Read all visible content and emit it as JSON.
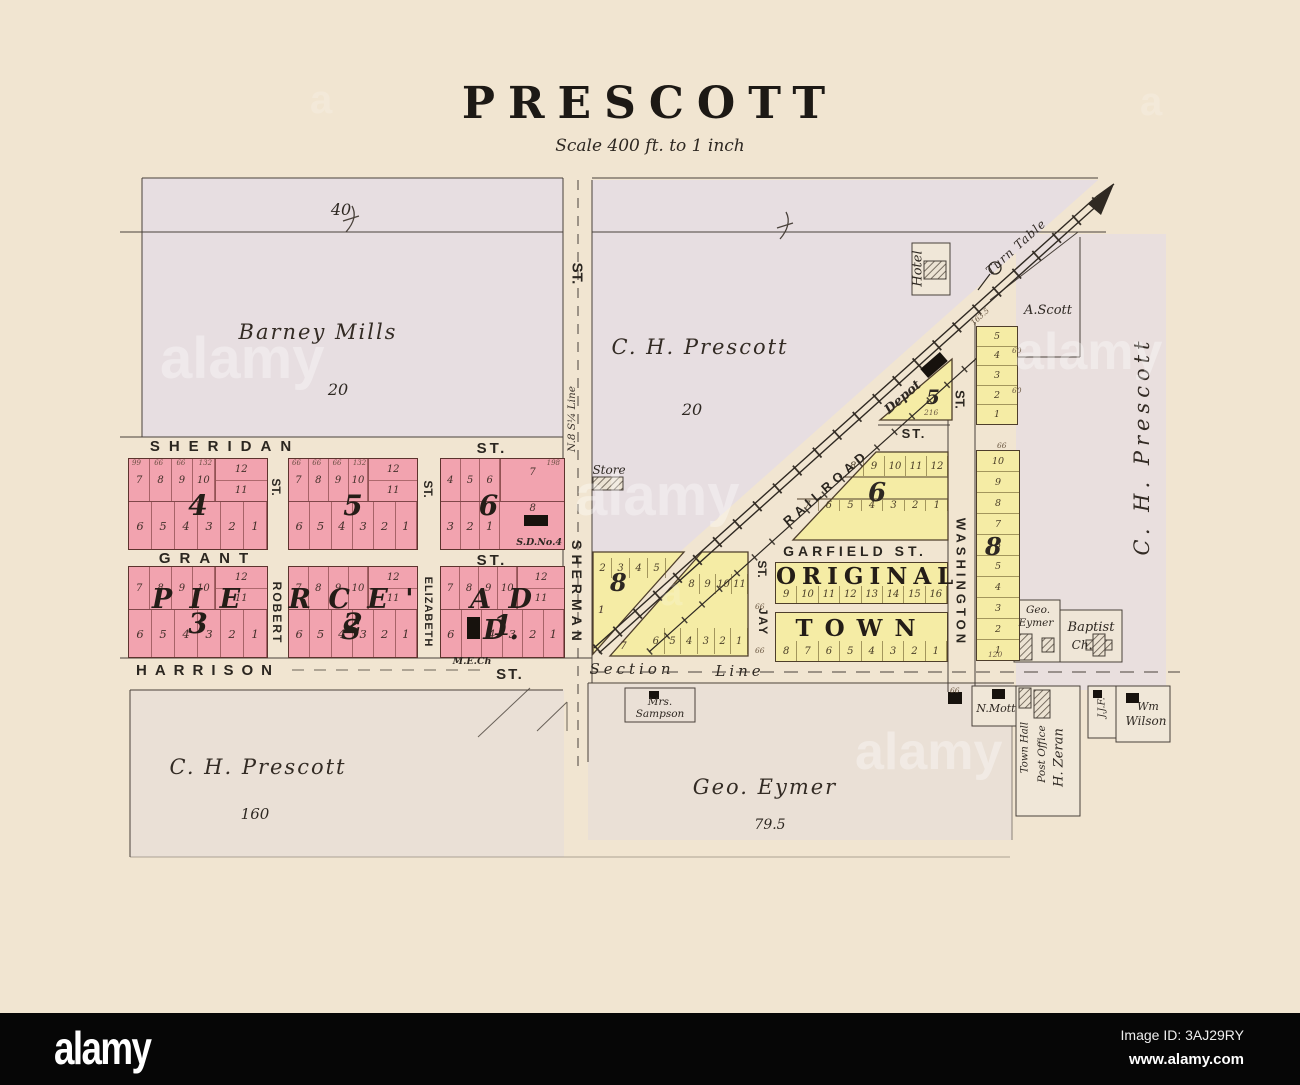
{
  "header": {
    "title": "PRESCOTT",
    "scale": "Scale 400 ft. to 1 inch"
  },
  "owners": {
    "barney": {
      "name": "Barney Mills",
      "top_acres": "40",
      "acres": "20"
    },
    "prescott_mid": {
      "name": "C. H. Prescott",
      "acres": "20"
    },
    "prescott_sw": {
      "name": "C. H. Prescott",
      "acres": "160"
    },
    "eymer": {
      "name": "Geo. Eymer",
      "acres": "79.5"
    },
    "prescott_east": {
      "name": "C. H. Prescott"
    },
    "scott": {
      "name": "A.Scott"
    }
  },
  "streets": {
    "sheridan": "SHERIDAN",
    "grant": "GRANT",
    "harrison": "HARRISON",
    "st": "ST.",
    "sherman": "SHERMAN",
    "robert": "ROBERT",
    "elizabeth": "ELIZABETH",
    "garfield": "GARFIELD ST.",
    "railroad": "RAILROAD",
    "washington": "WASHINGTON",
    "jay": "JAY",
    "section_a": "Section",
    "section_b": "Line",
    "quarter_line": "N.8 S¼ Line",
    "turn_table": "Turn Table"
  },
  "labels": {
    "hotel": "Hotel",
    "depot": "Depot",
    "store": "Store",
    "me_church": "M.E.Ch",
    "school": "S.D.No.4",
    "sampson_1": "Mrs.",
    "sampson_2": "Sampson",
    "mott": "N.Mott",
    "town_hall": "Town Hall",
    "post_office": "Post Office",
    "zeran": "H. Zeran",
    "jjf": "J.J.F.",
    "wilson_1": "Wm",
    "wilson_2": "Wilson",
    "eymer_1": "Geo.",
    "eymer_2": "Eymer",
    "baptist_1": "Baptist",
    "baptist_2": "Ch.",
    "original": "ORIGINAL",
    "town": "TOWN",
    "pierce_1": "P I E",
    "pierce_2": "R C E ' S",
    "pierce_3": "A D D."
  },
  "blocks": {
    "b4": {
      "num": "4",
      "top": [
        "7",
        "8",
        "9",
        "10"
      ],
      "r1": "12",
      "r2": "11",
      "bottom": [
        "6",
        "5",
        "4",
        "3",
        "2",
        "1"
      ],
      "dims": [
        "99",
        "66",
        "66",
        "132"
      ]
    },
    "b5": {
      "num": "5",
      "top": [
        "7",
        "8",
        "9",
        "10"
      ],
      "r1": "12",
      "r2": "11",
      "bottom": [
        "6",
        "5",
        "4",
        "3",
        "2",
        "1"
      ],
      "dims": [
        "66",
        "66",
        "66",
        "132"
      ]
    },
    "b6p": {
      "num": "6",
      "top": [
        "4",
        "5",
        "6"
      ],
      "lot7": "7",
      "lot8": "8",
      "bottom": [
        "3",
        "2",
        "1"
      ],
      "dim198": "198"
    },
    "b3": {
      "num": "3",
      "top": [
        "7",
        "8",
        "9",
        "10"
      ],
      "r1": "12",
      "r2": "11",
      "bottom": [
        "6",
        "5",
        "4",
        "3",
        "2",
        "1"
      ]
    },
    "b2": {
      "num": "2",
      "top": [
        "7",
        "8",
        "9",
        "10"
      ],
      "r1": "12",
      "r2": "11",
      "bottom": [
        "6",
        "5",
        "4",
        "3",
        "2",
        "1"
      ]
    },
    "b1": {
      "num": "1",
      "top": [
        "7",
        "8",
        "9",
        "10"
      ],
      "r1": "12",
      "r2": "11",
      "bottom": [
        "6",
        "5",
        "4",
        "3",
        "2",
        "1"
      ]
    },
    "b5y": {
      "num": "5",
      "dim": "216"
    },
    "b6y": {
      "num": "6",
      "top": [
        "8",
        "9",
        "10",
        "11",
        "12"
      ],
      "bottom": [
        "7",
        "6",
        "5",
        "4",
        "3",
        "2",
        "1"
      ]
    },
    "b8w": {
      "num": "8",
      "top": [
        "2",
        "3",
        "4",
        "5"
      ],
      "lot1": "1"
    },
    "b7y": {
      "top": [
        "8",
        "9",
        "10",
        "11"
      ],
      "bottom": [
        "6",
        "5",
        "4",
        "3",
        "2",
        "1"
      ],
      "lot7": "7"
    },
    "otn": [
      "9",
      "10",
      "11",
      "12",
      "13",
      "14",
      "15",
      "16"
    ],
    "ots": [
      "8",
      "7",
      "6",
      "5",
      "4",
      "3",
      "2",
      "1"
    ],
    "colA": [
      "5",
      "4",
      "3",
      "2",
      "1"
    ],
    "col8": {
      "num": "8",
      "lots": [
        "10",
        "9",
        "8",
        "7",
        "6",
        "5",
        "4",
        "3",
        "2",
        "1"
      ],
      "dim": "120"
    }
  },
  "dims": {
    "d66": "66",
    "d1635": "163.5",
    "d216": "216",
    "d120": "120",
    "d60": "60"
  },
  "watermark": {
    "tile": "alamy",
    "corner": "a"
  },
  "footer": {
    "logo": "alamy",
    "image_id": "Image ID: 3AJ29RY",
    "url": "www.alamy.com"
  }
}
